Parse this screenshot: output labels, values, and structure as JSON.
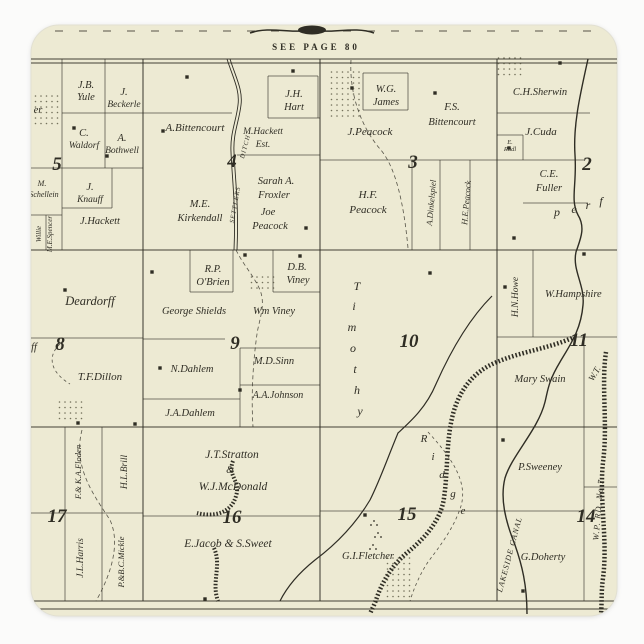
{
  "colors": {
    "page_bg": "#fbfbfa",
    "sticker_paper": "#edead3",
    "sticker_edge": "#e2e0d2",
    "ink": "#2f2d24",
    "stipple": "#55523f"
  },
  "map": {
    "see_page_note": "SEE PAGE 80",
    "sections": [
      {
        "num": "5",
        "x": 57,
        "y": 170
      },
      {
        "num": "4",
        "x": 232,
        "y": 167
      },
      {
        "num": "3",
        "x": 413,
        "y": 168
      },
      {
        "num": "2",
        "x": 587,
        "y": 170
      },
      {
        "num": "8",
        "x": 60,
        "y": 350
      },
      {
        "num": "9",
        "x": 235,
        "y": 349
      },
      {
        "num": "10",
        "x": 409,
        "y": 347
      },
      {
        "num": "11",
        "x": 579,
        "y": 346
      },
      {
        "num": "17",
        "x": 57,
        "y": 522
      },
      {
        "num": "16",
        "x": 232,
        "y": 523
      },
      {
        "num": "15",
        "x": 407,
        "y": 520
      },
      {
        "num": "14",
        "x": 586,
        "y": 522
      }
    ],
    "labels": [
      {
        "t": "J.B.",
        "x": 86,
        "y": 88
      },
      {
        "t": "Yule",
        "x": 86,
        "y": 100
      },
      {
        "t": "J.",
        "x": 124,
        "y": 95
      },
      {
        "t": "Beckerle",
        "x": 124,
        "y": 107,
        "fs": 9.5
      },
      {
        "t": "C.",
        "x": 84,
        "y": 136
      },
      {
        "t": "Waldorf",
        "x": 84,
        "y": 148,
        "fs": 9.5
      },
      {
        "t": "A.",
        "x": 122,
        "y": 141
      },
      {
        "t": "Bothwell",
        "x": 122,
        "y": 153,
        "fs": 9.5
      },
      {
        "t": "M.",
        "x": 42,
        "y": 186,
        "fs": 8
      },
      {
        "t": "Schellein",
        "x": 44,
        "y": 197,
        "fs": 8
      },
      {
        "t": "J.",
        "x": 90,
        "y": 190
      },
      {
        "t": "Knauff",
        "x": 90,
        "y": 202,
        "fs": 9.5
      },
      {
        "t": "J.Hackett",
        "x": 100,
        "y": 224
      },
      {
        "t": "er",
        "x": 38,
        "y": 113,
        "n": "cut-name-fragment"
      },
      {
        "t": "rff",
        "x": 32,
        "y": 350,
        "n": "cut-name-fragment"
      },
      {
        "t": "A.Bittencourt",
        "x": 195,
        "y": 131,
        "fs": 11
      },
      {
        "t": "M.Hackett",
        "x": 263,
        "y": 134,
        "fs": 9.5
      },
      {
        "t": "Est.",
        "x": 263,
        "y": 147,
        "fs": 9.5
      },
      {
        "t": "J.H.",
        "x": 294,
        "y": 97
      },
      {
        "t": "Hart",
        "x": 294,
        "y": 110
      },
      {
        "t": "Sarah A.",
        "x": 276,
        "y": 184
      },
      {
        "t": "Froxler",
        "x": 274,
        "y": 198
      },
      {
        "t": "Joe",
        "x": 268,
        "y": 215
      },
      {
        "t": "Peacock",
        "x": 270,
        "y": 229
      },
      {
        "t": "M.E.",
        "x": 200,
        "y": 207
      },
      {
        "t": "Kirkendall",
        "x": 200,
        "y": 221
      },
      {
        "t": "SETTLERS",
        "x": 237,
        "y": 205,
        "r": -80,
        "fs": 6.5,
        "ls": 1,
        "n": "waterway-label"
      },
      {
        "t": "DITCH",
        "x": 247,
        "y": 147,
        "r": -75,
        "fs": 6.5,
        "ls": 1,
        "n": "waterway-label"
      },
      {
        "t": "W.G.",
        "x": 386,
        "y": 92
      },
      {
        "t": "James",
        "x": 386,
        "y": 105
      },
      {
        "t": "F.S.",
        "x": 452,
        "y": 110
      },
      {
        "t": "Bittencourt",
        "x": 452,
        "y": 125
      },
      {
        "t": "J.Peacock",
        "x": 370,
        "y": 135,
        "fs": 11
      },
      {
        "t": "H.F.",
        "x": 368,
        "y": 198,
        "fs": 11
      },
      {
        "t": "Peacock",
        "x": 368,
        "y": 213,
        "fs": 11
      },
      {
        "t": "A.Dinkelspiel",
        "x": 434,
        "y": 203,
        "r": -85,
        "fs": 8.5
      },
      {
        "t": "H.E.Peacock",
        "x": 469,
        "y": 203,
        "r": -85,
        "fs": 8.5
      },
      {
        "t": "C.H.Sherwin",
        "x": 540,
        "y": 95
      },
      {
        "t": "J.Cuda",
        "x": 541,
        "y": 135,
        "fs": 11
      },
      {
        "t": "E.",
        "x": 510,
        "y": 144,
        "fs": 6.5
      },
      {
        "t": "Rudl",
        "x": 510,
        "y": 151,
        "fs": 6.5
      },
      {
        "t": "C.E.",
        "x": 549,
        "y": 177
      },
      {
        "t": "Fuller",
        "x": 549,
        "y": 191
      },
      {
        "t": "p",
        "x": 557,
        "y": 216,
        "fs": 12
      },
      {
        "t": "e",
        "x": 574,
        "y": 213,
        "fs": 12
      },
      {
        "t": "r",
        "x": 588,
        "y": 209,
        "fs": 12
      },
      {
        "t": "f",
        "x": 601,
        "y": 205,
        "fs": 12
      },
      {
        "t": "M.E.Spencer",
        "x": 52,
        "y": 234,
        "r": -90,
        "fs": 7
      },
      {
        "t": "Willie",
        "x": 41,
        "y": 234,
        "r": -90,
        "fs": 7
      },
      {
        "t": "Deardorff",
        "x": 90,
        "y": 305,
        "fs": 12.5
      },
      {
        "t": "T.F.Dillon",
        "x": 100,
        "y": 380,
        "fs": 11
      },
      {
        "t": "R.P.",
        "x": 213,
        "y": 272
      },
      {
        "t": "O'Brien",
        "x": 213,
        "y": 285
      },
      {
        "t": "D.B.",
        "x": 297,
        "y": 270
      },
      {
        "t": "Viney",
        "x": 298,
        "y": 283
      },
      {
        "t": "George Shields",
        "x": 194,
        "y": 314
      },
      {
        "t": "Wm Viney",
        "x": 274,
        "y": 314
      },
      {
        "t": "M.D.Sinn",
        "x": 274,
        "y": 364
      },
      {
        "t": "N.Dahlem",
        "x": 192,
        "y": 372
      },
      {
        "t": "A.A.Johnson",
        "x": 278,
        "y": 398,
        "fs": 10
      },
      {
        "t": "J.A.Dahlem",
        "x": 190,
        "y": 416
      },
      {
        "t": "H.N.Howe",
        "x": 518,
        "y": 297,
        "r": -90,
        "fs": 9.5
      },
      {
        "t": "W.Hampshire",
        "x": 545,
        "y": 297,
        "a": "start"
      },
      {
        "t": "Mary Swain",
        "x": 540,
        "y": 382
      },
      {
        "t": "W.T.",
        "x": 597,
        "y": 375,
        "r": -60,
        "fs": 9,
        "n": "cut-name-fragment"
      },
      {
        "t": "P.Sweeney",
        "x": 540,
        "y": 470
      },
      {
        "t": "G.Doherty",
        "x": 543,
        "y": 560
      },
      {
        "t": "LAKESIDE CANAL",
        "x": 512,
        "y": 555,
        "r": -75,
        "fs": 8,
        "ls": 1,
        "n": "waterway-label"
      },
      {
        "t": "W.P. RD. No 7",
        "x": 601,
        "y": 510,
        "r": -85,
        "fs": 8.5,
        "ls": 1,
        "n": "road-label"
      },
      {
        "t": "F.& K.A.Floden",
        "x": 81,
        "y": 472,
        "r": -90,
        "fs": 8.5
      },
      {
        "t": "J.L.Harris",
        "x": 83,
        "y": 558,
        "r": -90,
        "fs": 9.5
      },
      {
        "t": "H.L.Brill",
        "x": 127,
        "y": 472,
        "r": -90,
        "fs": 9.5
      },
      {
        "t": "P.&B.C.Mickle",
        "x": 124,
        "y": 562,
        "r": -90,
        "fs": 8.5
      },
      {
        "t": "J.T.Stratton",
        "x": 232,
        "y": 458,
        "fs": 11.5
      },
      {
        "t": "&",
        "x": 230,
        "y": 473,
        "fs": 10
      },
      {
        "t": "W.J.McDonald",
        "x": 233,
        "y": 490,
        "fs": 11.5
      },
      {
        "t": "E.Jacob & S.Sweet",
        "x": 228,
        "y": 547,
        "fs": 11.5
      },
      {
        "t": "G.I.Fletcher",
        "x": 368,
        "y": 559
      }
    ],
    "letter_trails": [
      {
        "name": "timothy",
        "fs": 12,
        "glyphs": [
          {
            "t": "T",
            "x": 357,
            "y": 290
          },
          {
            "t": "i",
            "x": 354,
            "y": 310
          },
          {
            "t": "m",
            "x": 352,
            "y": 331
          },
          {
            "t": "o",
            "x": 353,
            "y": 352
          },
          {
            "t": "t",
            "x": 355,
            "y": 373
          },
          {
            "t": "h",
            "x": 357,
            "y": 394
          },
          {
            "t": "y",
            "x": 360,
            "y": 415
          }
        ]
      },
      {
        "name": "ridge",
        "fs": 11,
        "glyphs": [
          {
            "t": "R",
            "x": 424,
            "y": 442
          },
          {
            "t": "i",
            "x": 433,
            "y": 460
          },
          {
            "t": "d",
            "x": 442,
            "y": 478
          },
          {
            "t": "g",
            "x": 453,
            "y": 497
          },
          {
            "t": "e",
            "x": 463,
            "y": 514
          }
        ]
      }
    ],
    "building_squares": [
      [
        74,
        128
      ],
      [
        107,
        156
      ],
      [
        163,
        131
      ],
      [
        187,
        77
      ],
      [
        293,
        71
      ],
      [
        352,
        88
      ],
      [
        435,
        93
      ],
      [
        560,
        63
      ],
      [
        509,
        148
      ],
      [
        514,
        238
      ],
      [
        152,
        272
      ],
      [
        300,
        256
      ],
      [
        65,
        290
      ],
      [
        78,
        423
      ],
      [
        160,
        368
      ],
      [
        240,
        390
      ],
      [
        505,
        287
      ],
      [
        503,
        440
      ],
      [
        523,
        591
      ],
      [
        365,
        515
      ],
      [
        306,
        228
      ],
      [
        584,
        254
      ],
      [
        135,
        424
      ],
      [
        205,
        599
      ],
      [
        245,
        255
      ],
      [
        430,
        273
      ]
    ],
    "stipple_patches": [
      [
        330,
        72,
        30,
        44
      ],
      [
        250,
        277,
        27,
        16
      ],
      [
        497,
        58,
        24,
        20
      ],
      [
        34,
        96,
        26,
        30
      ],
      [
        58,
        402,
        26,
        18
      ],
      [
        386,
        558,
        26,
        40
      ]
    ],
    "marsh_clusters": [
      [
        374,
        521
      ],
      [
        378,
        533
      ],
      [
        373,
        545
      ]
    ]
  }
}
